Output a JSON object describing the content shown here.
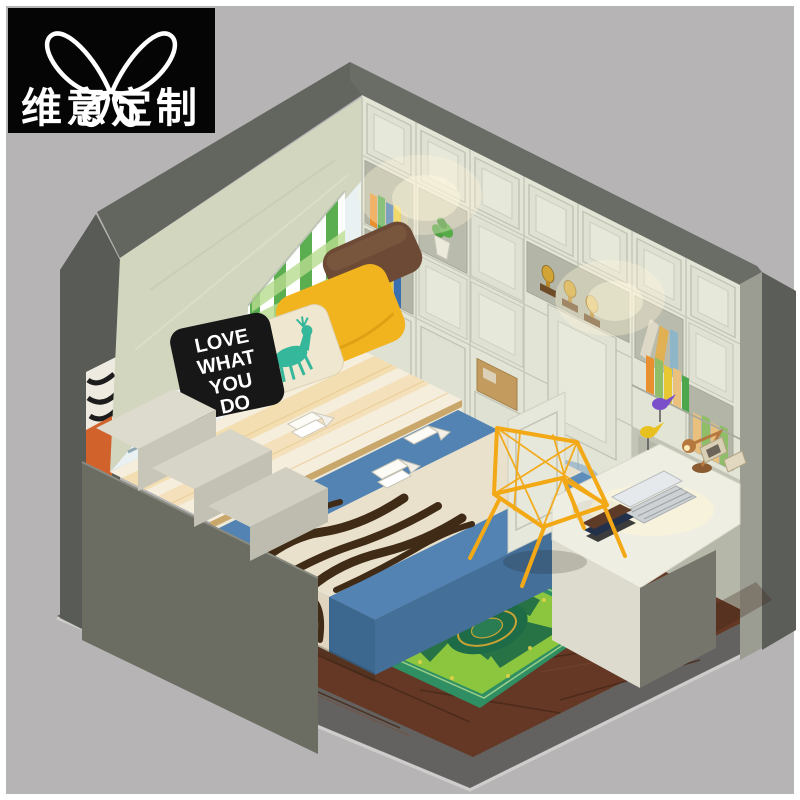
{
  "meta": {
    "canvas_width": 800,
    "canvas_height": 800,
    "image_kind": "isometric 3D interior render, product marketing image"
  },
  "logo": {
    "brand_text": "维意定制",
    "icon": "butterfly-outline-icon",
    "bg": "#050505",
    "fg": "#ffffff"
  },
  "pillow_text": {
    "lines": [
      "LOVE",
      "WHAT",
      "YOU",
      "DO"
    ]
  },
  "scene": {
    "type": "cutaway-isometric-bedroom",
    "palette": {
      "background": "#b6b4b5",
      "shell_dark": "#5c5e5a",
      "shell_band": "#6a6c66",
      "soffit_cream": "#d3d6bf",
      "wall_white": "#e9f1f2",
      "cabinet_cream": "#e2e4d6",
      "open_shelf": "#b3b5a7",
      "bed_blue": "#4e7fae",
      "zebra_cream": "#eae1cd",
      "zebra_brown": "#3f2b16",
      "pillow_yellow": "#f2b41e",
      "pillow_black": "#171717",
      "pillow_brown": "#6d4a35",
      "deer_teal": "#35b79b",
      "curtain_green": "#49a63e",
      "rug_green": "#8cc63e",
      "rug_dark": "#1e6b47",
      "floor_brown": "#6a3d28",
      "chair_yellow": "#f3a915",
      "desk_cream": "#efeee2",
      "trophy_gold": "#d2a335"
    },
    "objects": [
      "cutaway wall shell",
      "window with sheer curtain",
      "green plaid curtain",
      "window seat with checkered mat",
      "brown pillow",
      "yellow pillow",
      "deer print pillow",
      "black slogan pillow",
      "tatami platform bed with blue cover",
      "zebra print runner",
      "open books",
      "stepped storage cabinet",
      "wardrobe wall with shelves and doors",
      "trophies",
      "potted plant",
      "storage box",
      "corner desk with laptop",
      "book stack",
      "copper desk lamp",
      "photo frames",
      "bird figurines",
      "yellow wireframe chair",
      "green medallion rug",
      "dark wood plank floor"
    ]
  }
}
